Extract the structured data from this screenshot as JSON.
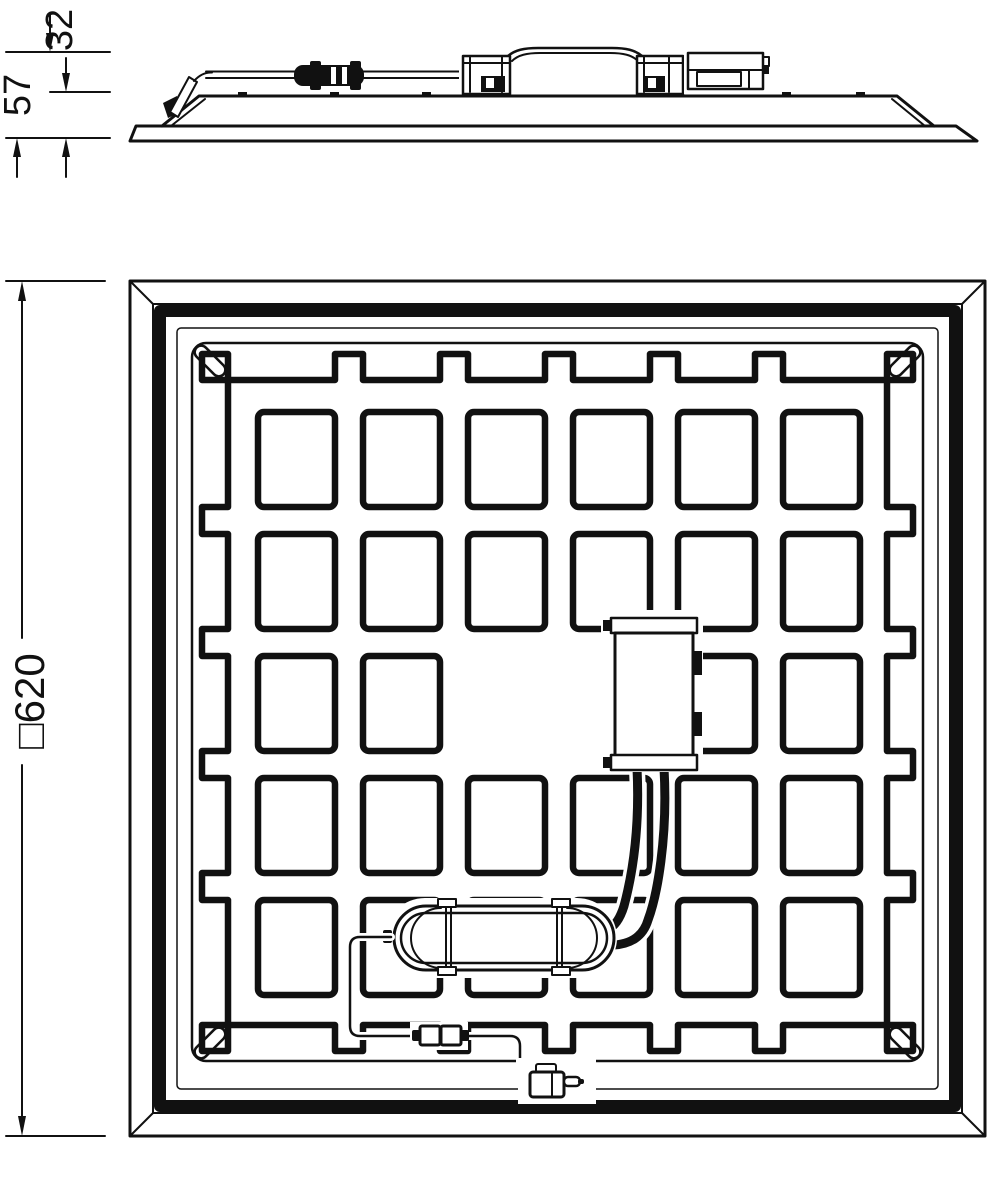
{
  "dimension_labels": {
    "overall_height": "57",
    "recess_height": "32",
    "panel_size": "□620"
  },
  "panel_grid": {
    "rows": 5,
    "cols": 6,
    "x0": 258,
    "y0": 412,
    "w": 77,
    "h": 95,
    "px": 105,
    "py": 122,
    "L": 228,
    "R": 887,
    "T": 380,
    "B": 1025,
    "bump": 26,
    "skip": [
      [
        2,
        2
      ],
      [
        2,
        3
      ]
    ]
  },
  "colors": {
    "line": "#111111",
    "background": "#ffffff"
  }
}
